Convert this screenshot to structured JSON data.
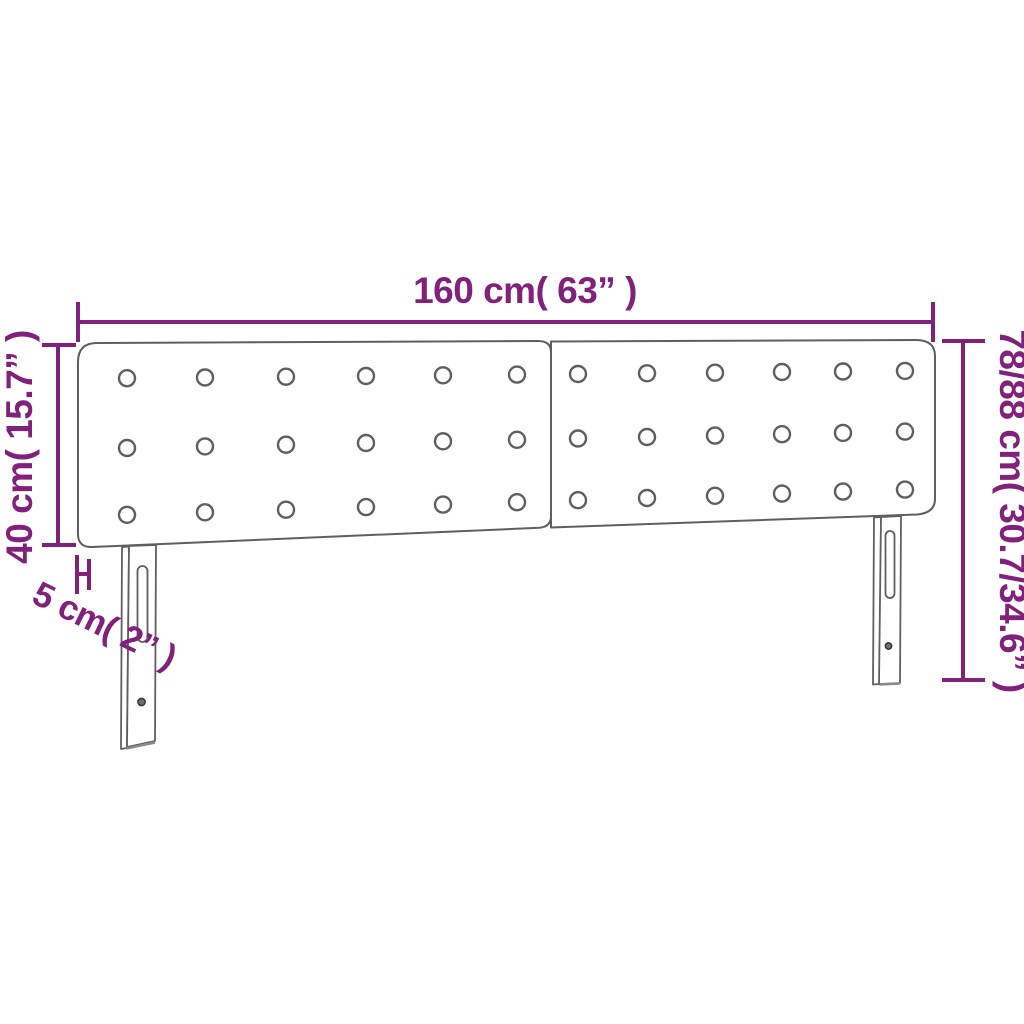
{
  "diagram": {
    "name": "headboard-dimension-diagram",
    "colors": {
      "dimension": "#82217c",
      "outline": "#5f5f5f",
      "background": "#ffffff"
    },
    "dimensions": {
      "width_label": "160 cm( 63” )",
      "panel_height_label": "40 cm( 15.7” )",
      "total_height_label": "78/88 cm( 30.7/34.6” )",
      "thickness_label": "5 cm( 2” )"
    },
    "headboard": {
      "panels": 2,
      "button_rows": 3,
      "button_cols_per_panel": 6,
      "legs": 2
    }
  }
}
